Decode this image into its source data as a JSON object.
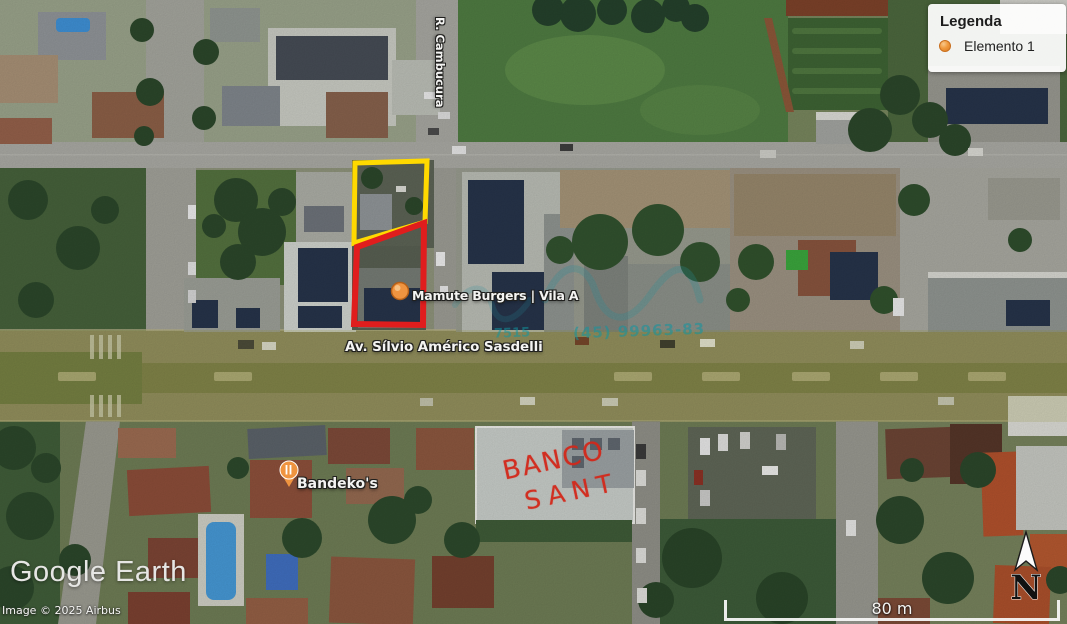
{
  "legend": {
    "title": "Legenda",
    "items": [
      {
        "icon": "orange-marker-icon",
        "label": "Elemento 1"
      }
    ]
  },
  "map_labels": {
    "poi_mamute": "Mamute Burgers | Vila A",
    "poi_bandekos": "Bandeko's",
    "avenue": "Av. Sílvio Américo Sasdelli",
    "cross_street": "R. Cambucura"
  },
  "annotations": {
    "handwriting_line1": "BANCO",
    "handwriting_line2": "SANT",
    "yellow_outline_color": "#ffd900",
    "red_outline_color": "#e01d1d",
    "marker_color": "#ef9440",
    "handwriting_color": "#d3281a"
  },
  "watermark": {
    "fragment_left": "7515",
    "fragment_right": "(45) 99963-83",
    "color": "#1096a0"
  },
  "branding": {
    "logo": "Google Earth",
    "copyright": "Image © 2025 Airbus"
  },
  "scale_bar": {
    "label": "80 m"
  },
  "compass": {
    "label": "N"
  }
}
